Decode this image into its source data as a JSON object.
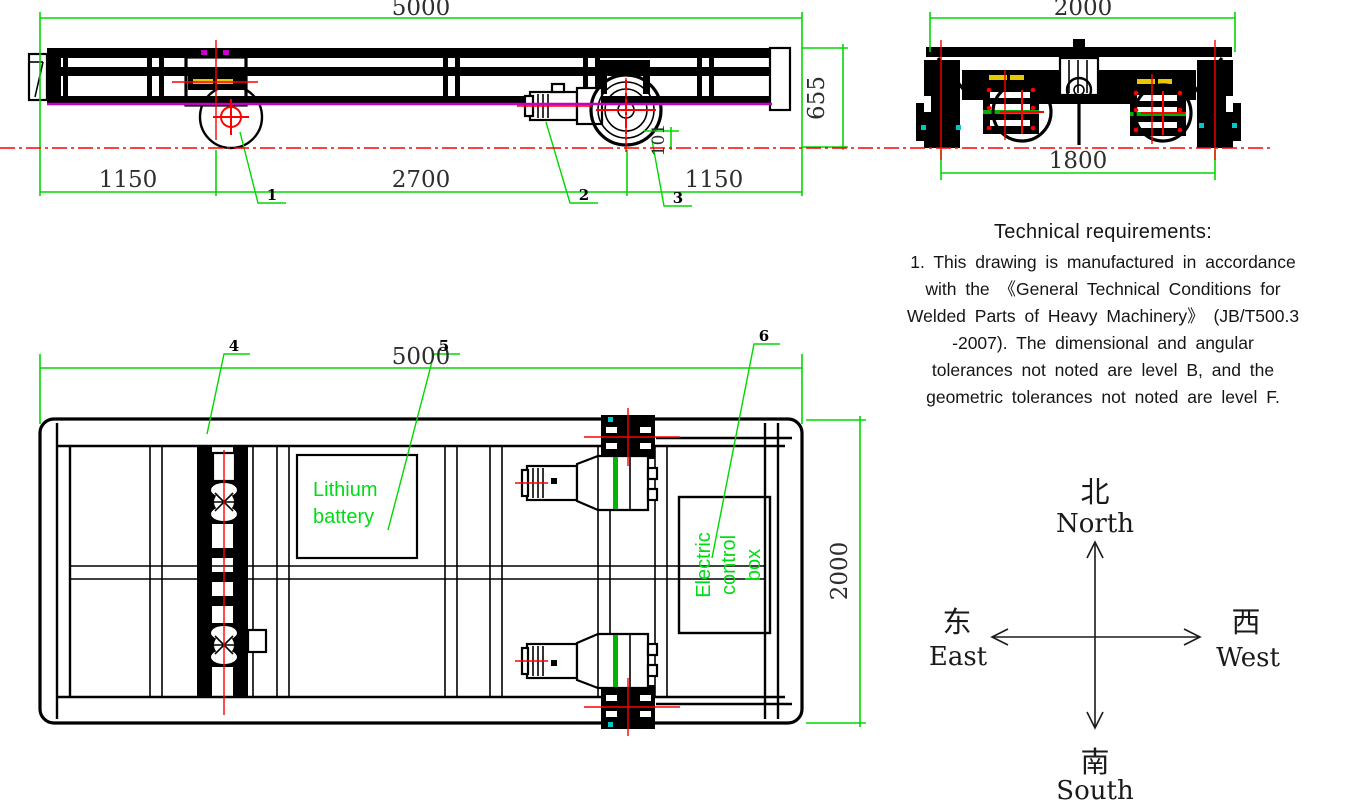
{
  "side_view": {
    "dims": {
      "total_length": "5000",
      "front_overhang": "1150",
      "wheelbase": "2700",
      "rear_overhang": "1150",
      "height": "655",
      "flange": "101"
    },
    "callouts": {
      "c1": "1",
      "c2": "2",
      "c3": "3"
    }
  },
  "end_view": {
    "dims": {
      "overall_width": "2000",
      "track_gauge": "1800"
    }
  },
  "top_view": {
    "dims": {
      "total_length": "5000",
      "overall_width": "2000"
    },
    "callouts": {
      "c4": "4",
      "c5": "5",
      "c6": "6"
    },
    "labels": {
      "battery": [
        "Lithium",
        "battery"
      ],
      "control": [
        "Electric",
        "control",
        "box"
      ]
    }
  },
  "technical_requirements": {
    "title": "Technical requirements:",
    "lines": [
      "1. This drawing is manufactured in accordance",
      "with the 《General Technical Conditions for",
      "Welded Parts of Heavy Machinery》 (JB/T500.3",
      "-2007). The dimensional and angular",
      "tolerances not noted are level B, and the",
      "geometric tolerances not noted are level F."
    ]
  },
  "compass": {
    "north_cn": "北",
    "north_en": "North",
    "south_cn": "南",
    "south_en": "South",
    "east_cn": "东",
    "east_en": "East",
    "west_cn": "西",
    "west_en": "West"
  },
  "colors": {
    "dimension_green": "#00d800",
    "label_green": "#00dc14",
    "centerline_red": "#ff0000",
    "rail_magenta": "#c400c4",
    "nameplate_yellow": "#e8c800",
    "drawing_black": "#000000"
  }
}
